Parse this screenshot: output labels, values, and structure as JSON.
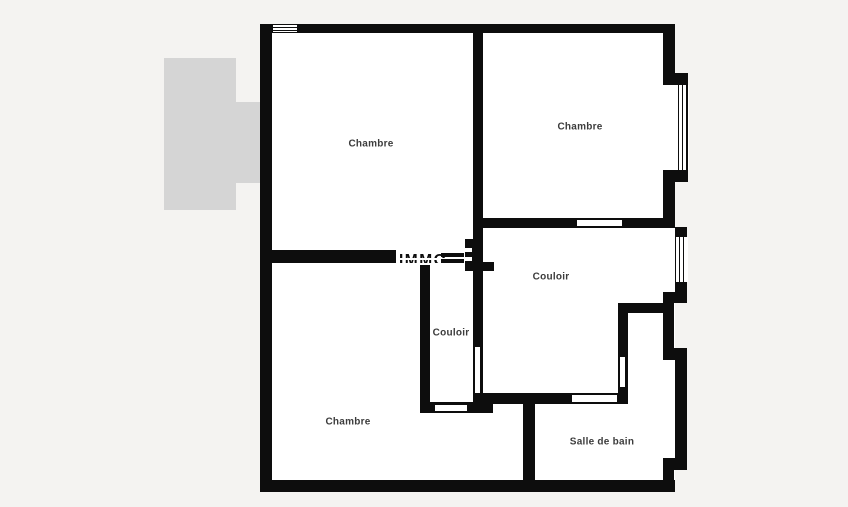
{
  "floorplan": {
    "colors": {
      "bg": "#f4f3f1",
      "wall": "#0d0d0d",
      "room": "#ffffff",
      "balcony": "#d5d5d5",
      "label": "#3c3c3c"
    },
    "rooms": {
      "chambre_top_left": "Chambre",
      "chambre_top_right": "Chambre",
      "couloir_upper": "Couloir",
      "couloir_lower": "Couloir",
      "chambre_bottom": "Chambre",
      "salle_de_bain": "Salle de bain"
    },
    "watermark": "IMMO"
  }
}
